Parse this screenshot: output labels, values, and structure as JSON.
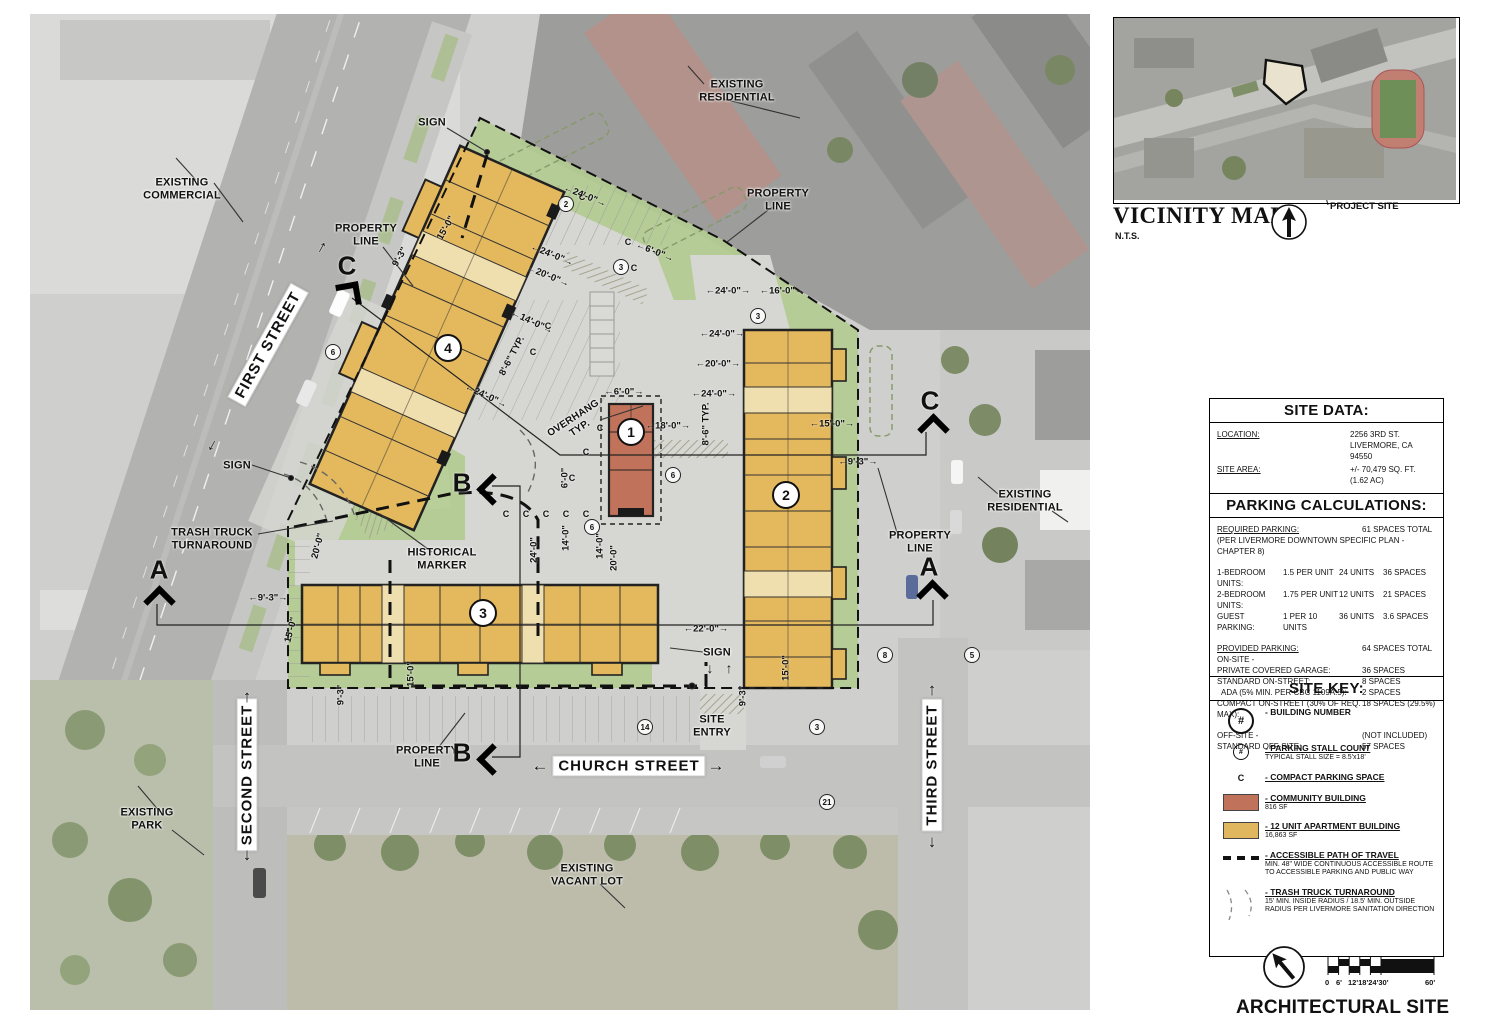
{
  "plan": {
    "streets": {
      "first": "FIRST STREET",
      "second": "SECOND STREET",
      "church": "CHURCH STREET",
      "third": "THIRD STREET"
    },
    "arrows": {
      "up": "↑",
      "down": "↓",
      "left": "←",
      "right": "→"
    },
    "annotations": {
      "sign_top": "SIGN",
      "existing_residential_top": "EXISTING\nRESIDENTIAL",
      "property_line_top": "PROPERTY\nLINE",
      "existing_commercial": "EXISTING\nCOMMERCIAL",
      "property_line_first": "PROPERTY\nLINE",
      "sign_left": "SIGN",
      "trash_truck": "TRASH TRUCK\nTURNAROUND",
      "historical_marker": "HISTORICAL\nMARKER",
      "overhang": "OVERHANG\nTYP.",
      "property_line_right": "PROPERTY\nLINE",
      "existing_residential_right": "EXISTING\nRESIDENTIAL",
      "property_line_bottom": "PROPERTY\nLINE",
      "sign_bottom": "SIGN",
      "site_entry": "SITE\nENTRY",
      "existing_park": "EXISTING\nPARK",
      "existing_vacant_lot": "EXISTING\nVACANT LOT"
    },
    "sections": {
      "a": "A",
      "b": "B",
      "c": "C"
    },
    "building_numbers": [
      "1",
      "2",
      "3",
      "4"
    ],
    "stall_counts": [
      "2",
      "3",
      "3",
      "6",
      "6",
      "6",
      "14",
      "3",
      "21",
      "8",
      "5"
    ],
    "compact_mark": "C",
    "dims": [
      "←24'-0\"→",
      "←6'-0\"→",
      "←24'-0\"→",
      "←20'-0\"→",
      "←14'-0\"→",
      "8'-6\" TYP.",
      "←24'-0\"→",
      "15'-0\"",
      "9'-3\"",
      "←24'-0\"→",
      "←16'-0\"→",
      "←24'-0\"→",
      "←20'-0\"→",
      "←24'-0\"→",
      "←18'-0\"→",
      "8'-6\" TYP.",
      "←6'-0\"→",
      "←15'-0\"→",
      "←9'-3\"→",
      "14'-0\"",
      "20'-0\"",
      "20'-0\"",
      "←9'-3\"→",
      "15'-0\"",
      "24'-0\"",
      "14'-0\"",
      "6'-0\"",
      "15'-0\"",
      "9'-3\"",
      "←22'-0\"→",
      "15'-0\"",
      "9'-3\""
    ]
  },
  "vicinity": {
    "title": "VICINITY MAP",
    "nts": "N.T.S.",
    "project_site": "PROJECT SITE"
  },
  "site_data": {
    "header": "SITE DATA:",
    "rows": [
      {
        "label": "LOCATION:",
        "value": "2256 3RD ST.\nLIVERMORE, CA\n94550"
      },
      {
        "label": "SITE AREA:",
        "value": "+/- 70,479 SQ. FT.\n(1.62 AC)"
      }
    ]
  },
  "parking": {
    "header": "PARKING CALCULATIONS:",
    "required_label": "REQUIRED PARKING:",
    "required_value": "61 SPACES TOTAL",
    "required_note": "(PER LIVERMORE DOWNTOWN SPECIFIC PLAN - CHAPTER 8)",
    "unit_rows": [
      {
        "label": "1-BEDROOM UNITS:",
        "rate": "1.5 PER UNIT",
        "units": "24 UNITS",
        "spaces": "36 SPACES"
      },
      {
        "label": "2-BEDROOM UNITS:",
        "rate": "1.75 PER UNIT",
        "units": "12 UNITS",
        "spaces": "21 SPACES"
      },
      {
        "label": "GUEST PARKING:",
        "rate": "1 PER 10 UNITS",
        "units": "36 UNITS",
        "spaces": "3.6 SPACES"
      }
    ],
    "provided_label": "PROVIDED PARKING:",
    "provided_value": "64 SPACES TOTAL",
    "onsite_label": "ON-SITE -",
    "provided_rows": [
      {
        "label": "PRIVATE COVERED GARAGE:",
        "value": "36 SPACES"
      },
      {
        "label": "STANDARD ON-STREET:",
        "value": "8 SPACES"
      },
      {
        "label": "  ADA (5% MIN. PER CBC 1109A.5):",
        "value": "2 SPACES"
      },
      {
        "label": "COMPACT ON-STREET (30% OF REQ. MAX):",
        "value": "18 SPACES (29.5%)"
      }
    ],
    "offsite_label": "OFF-SITE -",
    "offsite_value": "(NOT INCLUDED)",
    "offsite_rows": [
      {
        "label": "STANDARD OFF-SITE:",
        "value": "57 SPACES"
      }
    ]
  },
  "site_key": {
    "header": "SITE KEY:",
    "symbol_building": "#",
    "symbol_stall": "#",
    "symbol_compact": "C",
    "community_color": "#c1725a",
    "apartment_color": "#e0b65f",
    "items": [
      {
        "label": "- BUILDING NUMBER",
        "note": ""
      },
      {
        "label": "- PARKING STALL COUNT",
        "note": "TYPICAL STALL SIZE = 8.5'x18'"
      },
      {
        "label": "- COMPACT PARKING SPACE",
        "note": ""
      },
      {
        "label": "- COMMUNITY BUILDING",
        "note": "816 SF"
      },
      {
        "label": "- 12 UNIT APARTMENT BUILDING",
        "note": "16,863 SF"
      },
      {
        "label": "- ACCESSIBLE PATH OF TRAVEL",
        "note": "MIN. 48\" WIDE CONTINUOUS ACCESSIBLE ROUTE TO ACCESSIBLE PARKING AND PUBLIC WAY"
      },
      {
        "label": "- TRASH TRUCK TURNAROUND",
        "note": "15' MIN. INSIDE RADIUS / 18.5' MIN. OUTSIDE RADIUS PER LIVERMORE SANITATION DIRECTION"
      }
    ]
  },
  "titleblock": {
    "title": "ARCHITECTURAL SITE PLAN",
    "scale_labels": [
      "0",
      "6'",
      "12'18'24'30'",
      "60'"
    ]
  }
}
